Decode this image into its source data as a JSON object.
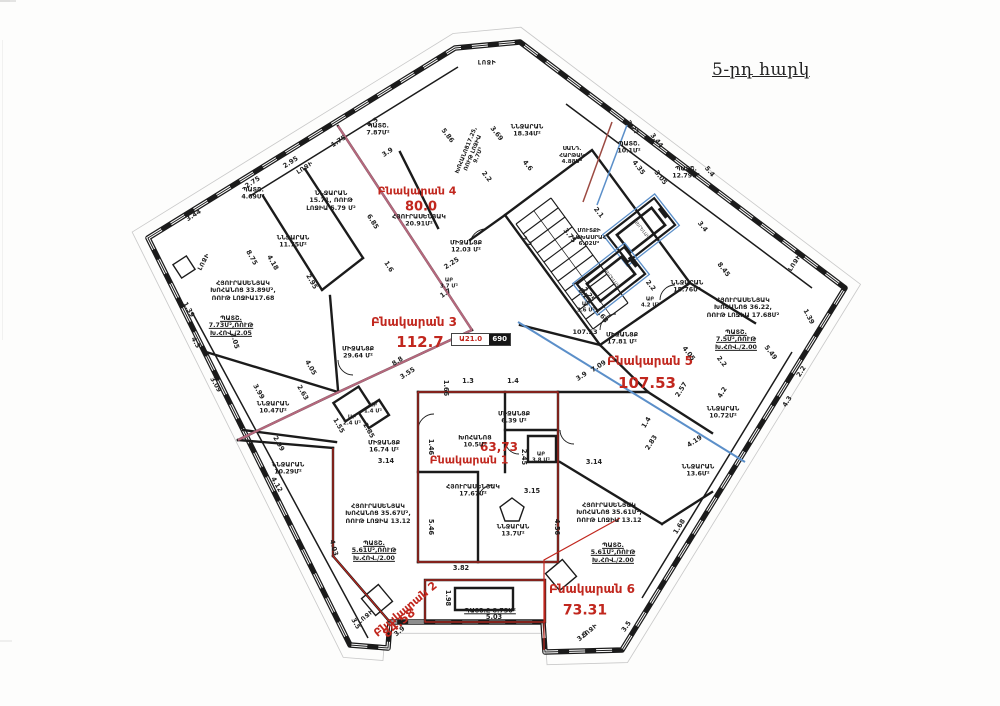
{
  "plan": {
    "title": "5-րդ հարկ",
    "marker": {
      "red": "Ա21.0",
      "black": "690"
    },
    "colors": {
      "wall": "#1b1b1b",
      "accent_red": "#c1271e",
      "boundary_pink": "#b5687d",
      "boundary_blue": "#5b8fc9"
    },
    "apartments": [
      {
        "name": "Բնակարան 1",
        "area": "63,73"
      },
      {
        "name": "Բնակարան 2",
        "area": "84.58"
      },
      {
        "name": "Բնակարան 3",
        "area": "112.7"
      },
      {
        "name": "Բնակարան 4",
        "area": "80.0"
      },
      {
        "name": "Բնակարան 5",
        "area": "107.53"
      },
      {
        "name": "Բնակարան 6",
        "area": "73.31"
      }
    ],
    "labels": [
      {
        "t": "Բնակարան 4",
        "k": "apt",
        "x": 417,
        "y": 192,
        "s": 11
      },
      {
        "t": "80.0",
        "k": "ara",
        "x": 421,
        "y": 207,
        "s": 13
      },
      {
        "t": "Բնակարան 3",
        "k": "apt",
        "x": 414,
        "y": 322,
        "s": 12
      },
      {
        "t": "112.7",
        "k": "ara",
        "x": 420,
        "y": 343,
        "s": 15
      },
      {
        "t": "Բնակարան 5",
        "k": "apt",
        "x": 650,
        "y": 361,
        "s": 12
      },
      {
        "t": "107.53",
        "k": "ara",
        "x": 647,
        "y": 384,
        "s": 15
      },
      {
        "t": "Բնակարան 1",
        "k": "apt",
        "x": 469,
        "y": 461,
        "s": 11
      },
      {
        "t": "63,73",
        "k": "ara",
        "x": 499,
        "y": 447,
        "s": 12
      },
      {
        "t": "Բնակարան 2",
        "k": "apt",
        "x": 406,
        "y": 610,
        "s": 11,
        "r": -40
      },
      {
        "t": "84.58",
        "k": "ara",
        "x": 399,
        "y": 623,
        "s": 12,
        "r": -40
      },
      {
        "t": "Բնակարան 6",
        "k": "apt",
        "x": 592,
        "y": 589,
        "s": 12
      },
      {
        "t": "73.31",
        "k": "ara",
        "x": 585,
        "y": 611,
        "s": 14
      },
      {
        "t": "ՊԱՏՇ.\n7.87Մ²",
        "k": "rm",
        "x": 378,
        "y": 130
      },
      {
        "t": "ՆՆՋԱՐԱՆ\n15.71, ՌՈՒԹ\nԼՈՋԻԱ 5.79 Մ²",
        "k": "rm",
        "x": 331,
        "y": 201
      },
      {
        "t": "ՊԱՏՇ.\n4.69Մ²",
        "k": "rm",
        "x": 253,
        "y": 194
      },
      {
        "t": "ՆՆՋԱՐԱՆ\n11.75Մ²",
        "k": "rm",
        "x": 293,
        "y": 242
      },
      {
        "t": "ՀՅՈՒՐԱՍԵՆՅԱԿ\nԽՈՀԱՆՈՑ 33.89Մ²,\nՌՈՒԹ ԼՈՋԻԱ17.68",
        "k": "rm",
        "x": 243,
        "y": 291
      },
      {
        "t": "ՊԱՏՇ.\n7.73Մ²,ՌՈՒԹ\nԽ.ՀՈՎ./2.05",
        "k": "rm",
        "x": 231,
        "y": 326,
        "u": 1
      },
      {
        "t": "ՆՆՋԱՐԱՆ\n10.47Մ²",
        "k": "rm",
        "x": 273,
        "y": 408
      },
      {
        "t": "ՆՆՋԱՐԱՆ\n10.29Մ²",
        "k": "rm",
        "x": 288,
        "y": 469
      },
      {
        "t": "ԱԲ\n1.4 Մ²",
        "k": "rm",
        "x": 373,
        "y": 409,
        "s": 5.4
      },
      {
        "t": "ԱԲ\n2.4 Մ²",
        "k": "rm",
        "x": 352,
        "y": 421,
        "s": 5.4
      },
      {
        "t": "ՄԻՋԱՆՑՔ\n16.74 Մ²",
        "k": "rm",
        "x": 384,
        "y": 447
      },
      {
        "t": "ՄԻՋԱՆՑՔ\n29.64 Մ²",
        "k": "rm",
        "x": 358,
        "y": 353
      },
      {
        "t": "ՄԻՋԱՆՑՔ\n12.03 Մ²",
        "k": "rm",
        "x": 466,
        "y": 247
      },
      {
        "t": "ԱԲ\n3.7 Մ²",
        "k": "rm",
        "x": 449,
        "y": 284,
        "s": 5.4
      },
      {
        "t": "ՀՅՈՒՐԱՍԵՆՅԱԿ\n20.91Մ²",
        "k": "rm",
        "x": 419,
        "y": 221
      },
      {
        "t": "ՆՆՋԱՐԱՆ\n18.34Մ²",
        "k": "rm",
        "x": 527,
        "y": 131
      },
      {
        "t": "ԽՈՀԱՆՈՑ17.25,\nՌՈՒԹ ԼՈՋԻԱ\n9.7Մ²",
        "k": "rm",
        "x": 473,
        "y": 153,
        "r": -68,
        "s": 5.6
      },
      {
        "t": "ՍԱՆԴ.\nՀԱՐԹԱԿ\n4.88Մ²",
        "k": "rm",
        "x": 572,
        "y": 156,
        "s": 5.6
      },
      {
        "t": "ՊԱՏՇ.\n10.1Մ²",
        "k": "rm",
        "x": 629,
        "y": 148
      },
      {
        "t": "ՊԱՏՇ.\n12.79Մ²",
        "k": "rm",
        "x": 686,
        "y": 173
      },
      {
        "t": "ՄՈՒՏՔԻ\nՆԱԽԱՍՐԱՀ\n6.02Մ²",
        "k": "rm",
        "x": 589,
        "y": 238,
        "s": 5.6
      },
      {
        "t": "ՆՆՋԱՐԱՆ\n15.76Մ²",
        "k": "rm",
        "x": 687,
        "y": 287
      },
      {
        "t": "ԱԲ\n3.6 Մ²",
        "k": "rm",
        "x": 586,
        "y": 308,
        "s": 5.4
      },
      {
        "t": "ԱԲ\n4.2 Մ²",
        "k": "rm",
        "x": 650,
        "y": 303,
        "s": 5.4
      },
      {
        "t": "ՀՅՈՒՐԱՍԵՆՅԱԿ\nԽՈՀԱՆՈՑ 36.22,\nՌՈՒԹ ԼՈՋԻԱ 17.68Մ²",
        "k": "rm",
        "x": 743,
        "y": 308
      },
      {
        "t": "ՊԱՏՇ.\n7.5Մ²,ՌՈՒԹ\nԽ.ՀՈՎ./2.00",
        "k": "rm",
        "x": 736,
        "y": 340,
        "u": 1
      },
      {
        "t": "107.53",
        "k": "rm",
        "x": 585,
        "y": 333,
        "s": 6.5
      },
      {
        "t": "ՄԻՋԱՆՑՔ\n17.81 Մ²",
        "k": "rm",
        "x": 622,
        "y": 339
      },
      {
        "t": "ՆՆՋԱՐԱՆ\n10.72Մ²",
        "k": "rm",
        "x": 723,
        "y": 413
      },
      {
        "t": "ՆՆՋԱՐԱՆ\n13.6Մ²",
        "k": "rm",
        "x": 698,
        "y": 471
      },
      {
        "t": "ԽՈՀԱՆՈՑ\n10.5Մ²",
        "k": "rm",
        "x": 475,
        "y": 442
      },
      {
        "t": "ՄԻՋԱՆՑՔ\n6.39 Մ²",
        "k": "rm",
        "x": 514,
        "y": 418
      },
      {
        "t": "ԱԲ\n3.8 Մ²",
        "k": "rm",
        "x": 541,
        "y": 458,
        "s": 5.4
      },
      {
        "t": "ՀՅՈՒՐԱՍԵՆՅԱԿ\n17.67Մ²",
        "k": "rm",
        "x": 473,
        "y": 491
      },
      {
        "t": "ՆՆՋԱՐԱՆ\n13.7Մ²",
        "k": "rm",
        "x": 513,
        "y": 531
      },
      {
        "t": "ՀՅՈՒՐԱՍԵՆՅԱԿ\nԽՈՀԱՆՈՑ 35.67Մ²,\nՌՈՒԹ ԼՈՋԻԱ 13.12",
        "k": "rm",
        "x": 378,
        "y": 514
      },
      {
        "t": "ՊԱՏՇ.\n5.61Մ²,ՌՈՒԹ\nԽ.ՀՈՎ./2.00",
        "k": "rm",
        "x": 374,
        "y": 551,
        "u": 1
      },
      {
        "t": "ՀՅՈՒՐԱՍԵՆՅԱԿ\nԽՈՀԱՆՈՑ 35.61Մ²,\nՌՈՒԹ ԼՈՋԻԱ 13.12",
        "k": "rm",
        "x": 609,
        "y": 513
      },
      {
        "t": "ՊԱՏՇ.\n5.61Մ²,ՌՈՒԹ\nԽ.ՀՈՎ./2.00",
        "k": "rm",
        "x": 613,
        "y": 553,
        "u": 1
      },
      {
        "t": "ՊԱՏՇ.Ը 8.73Մ²",
        "k": "rm",
        "x": 490,
        "y": 611,
        "u": 1
      },
      {
        "t": "ԼՈՋԻ",
        "k": "lj",
        "x": 487,
        "y": 63
      },
      {
        "t": "ԼՈՋԻ",
        "k": "lj",
        "x": 305,
        "y": 168,
        "r": -33
      },
      {
        "t": "ԼՈՋԻ",
        "k": "lj",
        "x": 204,
        "y": 262,
        "r": -62
      },
      {
        "t": "ԼՈՋԻ",
        "k": "lj",
        "x": 795,
        "y": 263,
        "r": -57
      },
      {
        "t": "ԼՈՋԻ",
        "k": "lj",
        "x": 366,
        "y": 617,
        "r": -40
      },
      {
        "t": "ԼՈՋԻ",
        "k": "lj",
        "x": 590,
        "y": 631,
        "r": -40
      },
      {
        "t": "ՎԵՐԵԼԱԿ",
        "k": "el",
        "x": 641,
        "y": 230,
        "r": 52
      },
      {
        "t": "ՎԵՐԵԼԱԿ",
        "k": "el",
        "x": 611,
        "y": 279,
        "r": 52
      },
      {
        "t": "3.44",
        "k": "dm",
        "x": 194,
        "y": 216,
        "r": -33
      },
      {
        "t": "2.75",
        "k": "dm",
        "x": 253,
        "y": 183,
        "r": -33
      },
      {
        "t": "2.95",
        "k": "dm",
        "x": 291,
        "y": 163,
        "r": -33
      },
      {
        "t": "1.75",
        "k": "dm",
        "x": 339,
        "y": 142,
        "r": -33
      },
      {
        "t": "4.5",
        "k": "dm",
        "x": 373,
        "y": 123,
        "r": -33
      },
      {
        "t": "3.9",
        "k": "dm",
        "x": 388,
        "y": 153,
        "r": -33
      },
      {
        "t": "5.86",
        "k": "dm",
        "x": 447,
        "y": 136,
        "r": 52
      },
      {
        "t": "3.69",
        "k": "dm",
        "x": 496,
        "y": 134,
        "r": 52
      },
      {
        "t": "2.2",
        "k": "dm",
        "x": 486,
        "y": 177,
        "r": 52
      },
      {
        "t": "4.6",
        "k": "dm",
        "x": 527,
        "y": 166,
        "r": 52
      },
      {
        "t": "3.27",
        "k": "dm",
        "x": 632,
        "y": 128,
        "r": 52
      },
      {
        "t": "3.44",
        "k": "dm",
        "x": 656,
        "y": 141,
        "r": 52
      },
      {
        "t": "4.35",
        "k": "dm",
        "x": 638,
        "y": 168,
        "r": 52
      },
      {
        "t": "3.05",
        "k": "dm",
        "x": 660,
        "y": 178,
        "r": 52
      },
      {
        "t": "5.4",
        "k": "dm",
        "x": 709,
        "y": 172,
        "r": 52
      },
      {
        "t": "3.4",
        "k": "dm",
        "x": 702,
        "y": 227,
        "r": 52
      },
      {
        "t": "2.1",
        "k": "dm",
        "x": 598,
        "y": 213,
        "r": 52
      },
      {
        "t": "2.2",
        "k": "dm",
        "x": 650,
        "y": 286,
        "r": 52
      },
      {
        "t": "2.25",
        "k": "dm",
        "x": 584,
        "y": 296,
        "r": 52
      },
      {
        "t": "8.45",
        "k": "dm",
        "x": 723,
        "y": 270,
        "r": 52
      },
      {
        "t": "1.39",
        "k": "dm",
        "x": 808,
        "y": 317,
        "r": 62
      },
      {
        "t": "5.49",
        "k": "dm",
        "x": 770,
        "y": 353,
        "r": 52
      },
      {
        "t": "2.2",
        "k": "dm",
        "x": 721,
        "y": 362,
        "r": 52
      },
      {
        "t": "4.05",
        "k": "dm",
        "x": 688,
        "y": 354,
        "r": 52
      },
      {
        "t": "2.2",
        "k": "dm",
        "x": 802,
        "y": 372,
        "r": -58
      },
      {
        "t": "4.3",
        "k": "dm",
        "x": 788,
        "y": 402,
        "r": -58
      },
      {
        "t": "4.2",
        "k": "dm",
        "x": 723,
        "y": 393,
        "r": -58
      },
      {
        "t": "2.57",
        "k": "dm",
        "x": 682,
        "y": 390,
        "r": -58
      },
      {
        "t": "1.4",
        "k": "dm",
        "x": 647,
        "y": 423,
        "r": -58
      },
      {
        "t": "2.83",
        "k": "dm",
        "x": 652,
        "y": 443,
        "r": -58
      },
      {
        "t": "4.19",
        "k": "dm",
        "x": 695,
        "y": 442,
        "r": -33
      },
      {
        "t": "1.68",
        "k": "dm",
        "x": 680,
        "y": 527,
        "r": -58
      },
      {
        "t": "3.9",
        "k": "dm",
        "x": 582,
        "y": 377,
        "r": -33
      },
      {
        "t": "7.09",
        "k": "dm",
        "x": 599,
        "y": 367,
        "r": -33
      },
      {
        "t": "1.68",
        "k": "dm",
        "x": 601,
        "y": 316,
        "r": 52
      },
      {
        "t": "8.8",
        "k": "dm",
        "x": 398,
        "y": 362,
        "r": -33
      },
      {
        "t": "3.55",
        "k": "dm",
        "x": 408,
        "y": 374,
        "r": -33
      },
      {
        "t": "6.85",
        "k": "dm",
        "x": 372,
        "y": 222,
        "r": 58
      },
      {
        "t": "1.6",
        "k": "dm",
        "x": 388,
        "y": 267,
        "r": 58
      },
      {
        "t": "1.7",
        "k": "dm",
        "x": 446,
        "y": 294,
        "r": -33
      },
      {
        "t": "2.25",
        "k": "dm",
        "x": 452,
        "y": 264,
        "r": -33
      },
      {
        "t": "2.2",
        "k": "dm",
        "x": 526,
        "y": 242,
        "r": 52
      },
      {
        "t": "3.75",
        "k": "dm",
        "x": 569,
        "y": 236,
        "r": 52
      },
      {
        "t": "2.25",
        "k": "dm",
        "x": 588,
        "y": 295,
        "r": 52
      },
      {
        "t": "1.3",
        "k": "dm",
        "x": 468,
        "y": 382
      },
      {
        "t": "1.4",
        "k": "dm",
        "x": 513,
        "y": 382
      },
      {
        "t": "1.66",
        "k": "dm",
        "x": 445,
        "y": 388,
        "r": 90
      },
      {
        "t": "1.39",
        "k": "dm",
        "x": 188,
        "y": 310,
        "r": 60
      },
      {
        "t": "4.3",
        "k": "dm",
        "x": 195,
        "y": 343,
        "r": 60
      },
      {
        "t": "8.75",
        "k": "dm",
        "x": 251,
        "y": 258,
        "r": 60
      },
      {
        "t": "4.18",
        "k": "dm",
        "x": 272,
        "y": 263,
        "r": 60
      },
      {
        "t": "2.95",
        "k": "dm",
        "x": 311,
        "y": 282,
        "r": 60
      },
      {
        "t": "3.09",
        "k": "dm",
        "x": 215,
        "y": 385,
        "r": 60
      },
      {
        "t": "3.99",
        "k": "dm",
        "x": 258,
        "y": 392,
        "r": 60
      },
      {
        "t": "2.63",
        "k": "dm",
        "x": 302,
        "y": 393,
        "r": 60
      },
      {
        "t": "4.05",
        "k": "dm",
        "x": 310,
        "y": 368,
        "r": 60
      },
      {
        "t": "2.99",
        "k": "dm",
        "x": 278,
        "y": 444,
        "r": 60
      },
      {
        "t": "4.12",
        "k": "dm",
        "x": 276,
        "y": 485,
        "r": 60
      },
      {
        "t": "1.55",
        "k": "dm",
        "x": 338,
        "y": 426,
        "r": 60
      },
      {
        "t": "2.85",
        "k": "dm",
        "x": 368,
        "y": 431,
        "r": 60
      },
      {
        "t": "3.14",
        "k": "dm",
        "x": 386,
        "y": 462
      },
      {
        "t": "3.14",
        "k": "dm",
        "x": 594,
        "y": 463
      },
      {
        "t": "3.15",
        "k": "dm",
        "x": 532,
        "y": 492
      },
      {
        "t": "1.46",
        "k": "dm",
        "x": 430,
        "y": 447,
        "r": 90
      },
      {
        "t": "5.46",
        "k": "dm",
        "x": 430,
        "y": 527,
        "r": 90
      },
      {
        "t": "4.56",
        "k": "dm",
        "x": 556,
        "y": 527,
        "r": 90
      },
      {
        "t": "2.45",
        "k": "dm",
        "x": 523,
        "y": 457,
        "r": 90
      },
      {
        "t": "1.98",
        "k": "dm",
        "x": 447,
        "y": 598,
        "r": 90
      },
      {
        "t": "3.82",
        "k": "dm",
        "x": 461,
        "y": 569
      },
      {
        "t": "5.03",
        "k": "dm",
        "x": 494,
        "y": 618
      },
      {
        "t": "3.9",
        "k": "dm",
        "x": 400,
        "y": 632,
        "r": -40
      },
      {
        "t": "3.5",
        "k": "dm",
        "x": 355,
        "y": 624,
        "r": 60
      },
      {
        "t": "3.9",
        "k": "dm",
        "x": 583,
        "y": 637,
        "r": -40
      },
      {
        "t": "3.5",
        "k": "dm",
        "x": 627,
        "y": 627,
        "r": -55
      },
      {
        "t": "4.03",
        "k": "dm",
        "x": 333,
        "y": 548,
        "r": 75
      },
      {
        "t": "2.05",
        "k": "dm",
        "x": 234,
        "y": 341,
        "r": 75
      }
    ]
  }
}
